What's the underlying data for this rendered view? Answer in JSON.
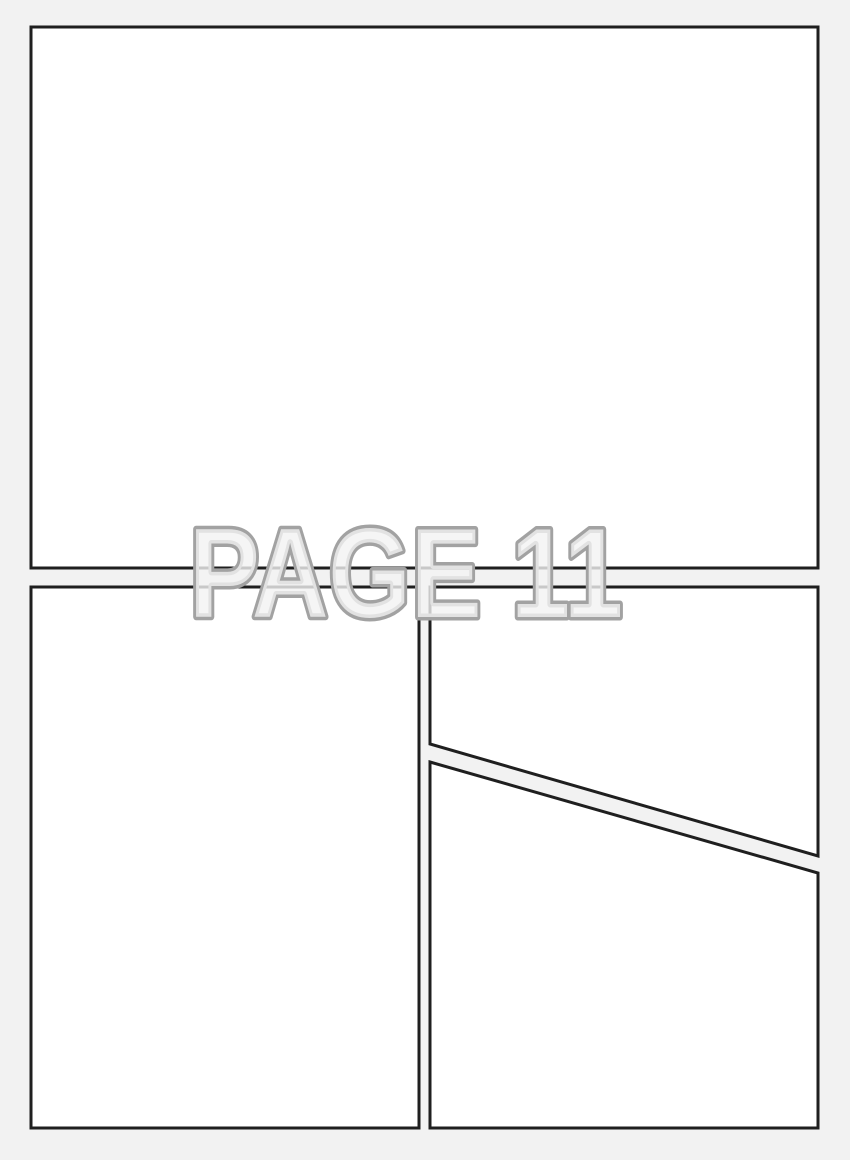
{
  "page": {
    "title": "PAGE 11",
    "panel_count": 4,
    "colors": {
      "background": "#f2f2f2",
      "panel_fill": "#ffffff",
      "panel_border": "#1f1f1f",
      "title_outline": "#a2a2a2",
      "title_fill": "#f3f3f3"
    }
  }
}
